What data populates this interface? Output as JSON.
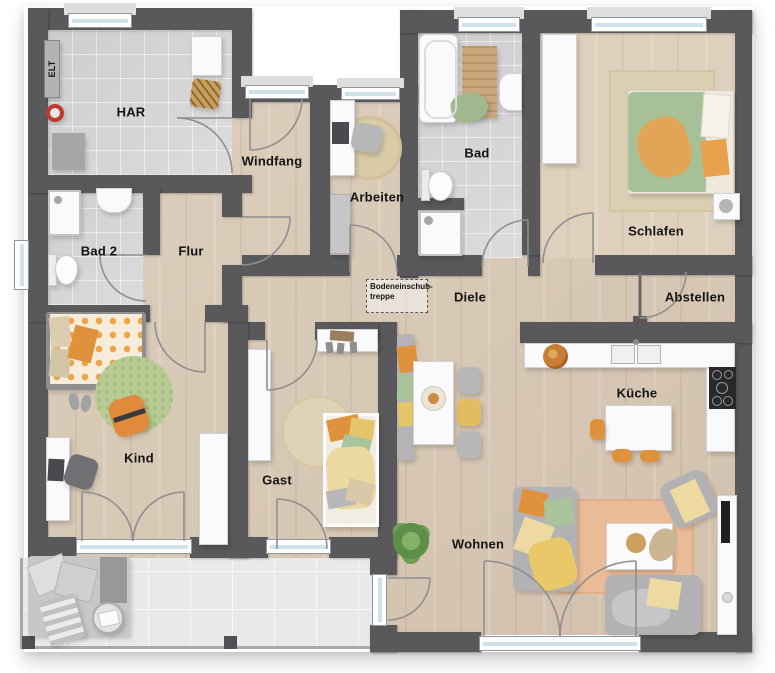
{
  "title": "Grundriss (floor plan)",
  "rooms": {
    "har": "HAR",
    "elt": "ELT",
    "windfang": "Windfang",
    "arbeiten": "Arbeiten",
    "bad": "Bad",
    "schlafen": "Schlafen",
    "bad2": "Bad 2",
    "flur": "Flur",
    "diele": "Diele",
    "abstellen": "Abstellen",
    "kind": "Kind",
    "gast": "Gast",
    "kueche": "Küche",
    "wohnen": "Wohnen"
  },
  "annotations": {
    "attic_hatch_line1": "Bodeneinschub-",
    "attic_hatch_line2": "treppe"
  },
  "colors": {
    "wall": "#59595c",
    "wood_floor": "#d9c9b6",
    "tile_floor": "#d9d9db",
    "terrace_floor": "#e9e9eb",
    "window_glass": "#cfe2ec",
    "accent_orange": "#e0913c",
    "accent_yellow": "#e8c868",
    "accent_green": "#a9c49a",
    "label_text": "#141414"
  }
}
